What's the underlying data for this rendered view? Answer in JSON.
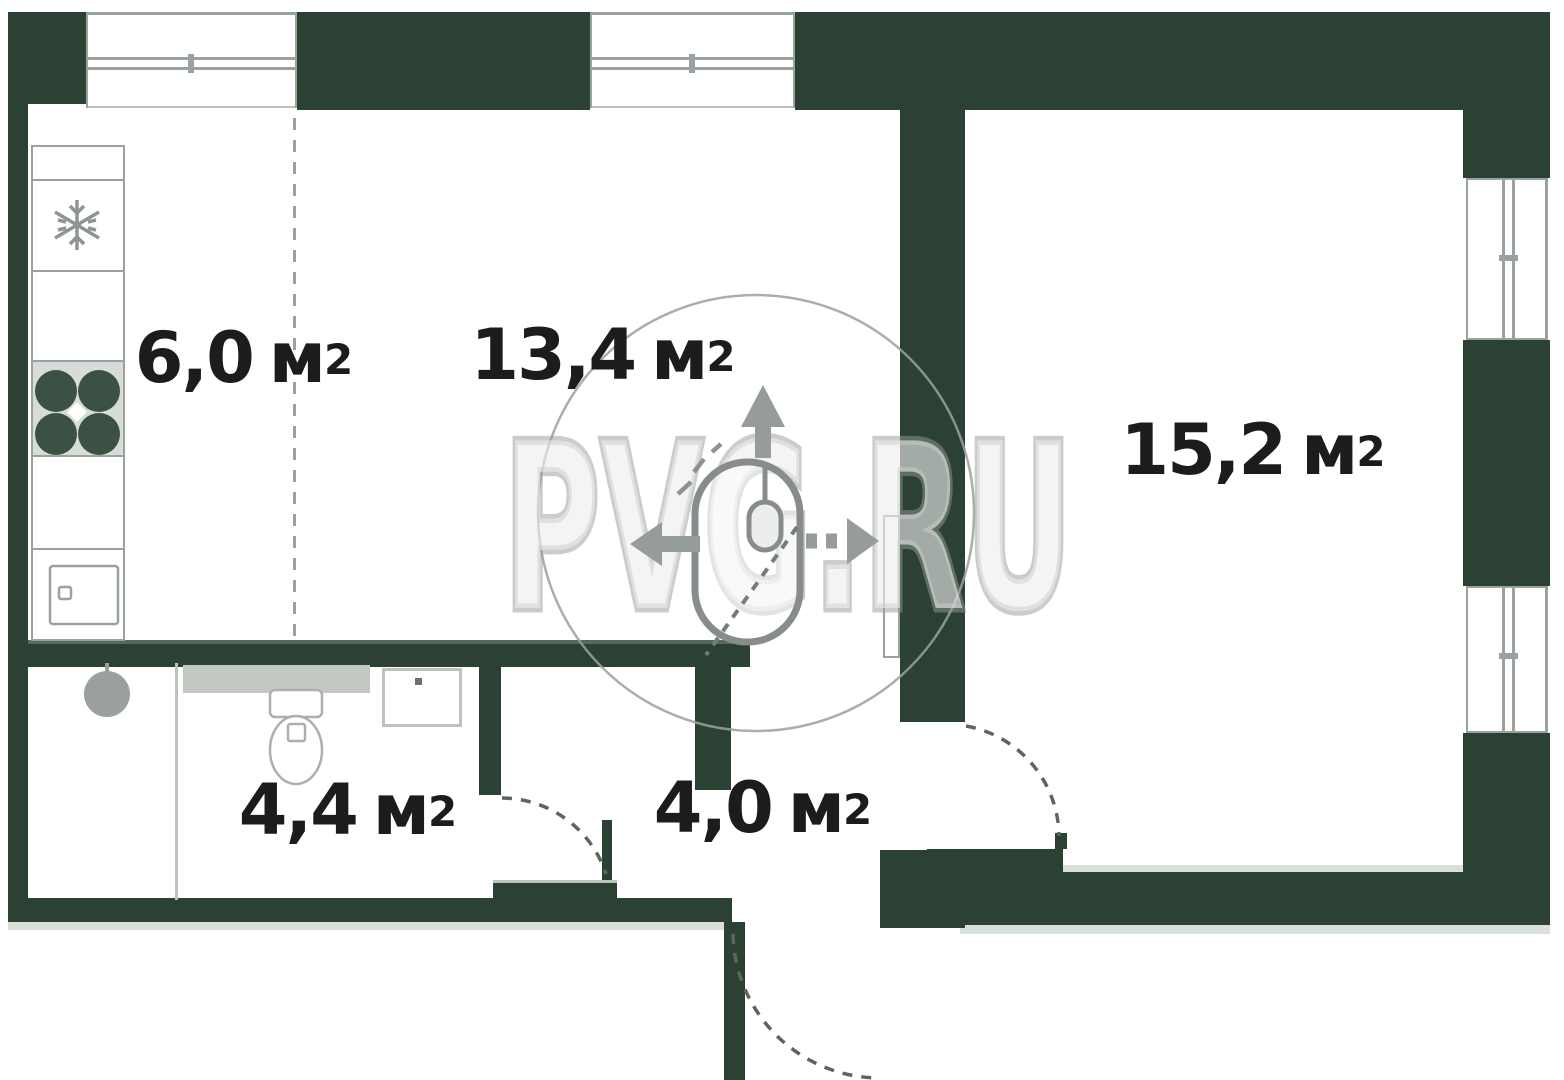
{
  "watermark": {
    "text": "PVG.RU"
  },
  "rooms": [
    {
      "name": "kitchen",
      "area": "6,0",
      "unit": "м",
      "sup": "2"
    },
    {
      "name": "living-room",
      "area": "13,4",
      "unit": "м",
      "sup": "2"
    },
    {
      "name": "bedroom",
      "area": "15,2",
      "unit": "м",
      "sup": "2"
    },
    {
      "name": "bathroom",
      "area": "4,4",
      "unit": "м",
      "sup": "2"
    },
    {
      "name": "hallway",
      "area": "4,0",
      "unit": "м",
      "sup": "2"
    }
  ],
  "fixtures": [
    "fridge",
    "stove",
    "kitchen-sink",
    "washing-machine",
    "toilet",
    "wash-basin",
    "door-swing"
  ],
  "colors": {
    "wall": "#2b4133",
    "shadow": "#d9dfd9",
    "outline": "#9aa29c",
    "outline-light": "#bcc3bc",
    "fixture-fill": "#c3c8c2",
    "stove-fill": "#d7dcd6",
    "burner": "#3a5144",
    "machine": "#9aa09b",
    "label": "#1c1c1c",
    "arc": "#5c655e",
    "watermark": "#9ba19c"
  }
}
